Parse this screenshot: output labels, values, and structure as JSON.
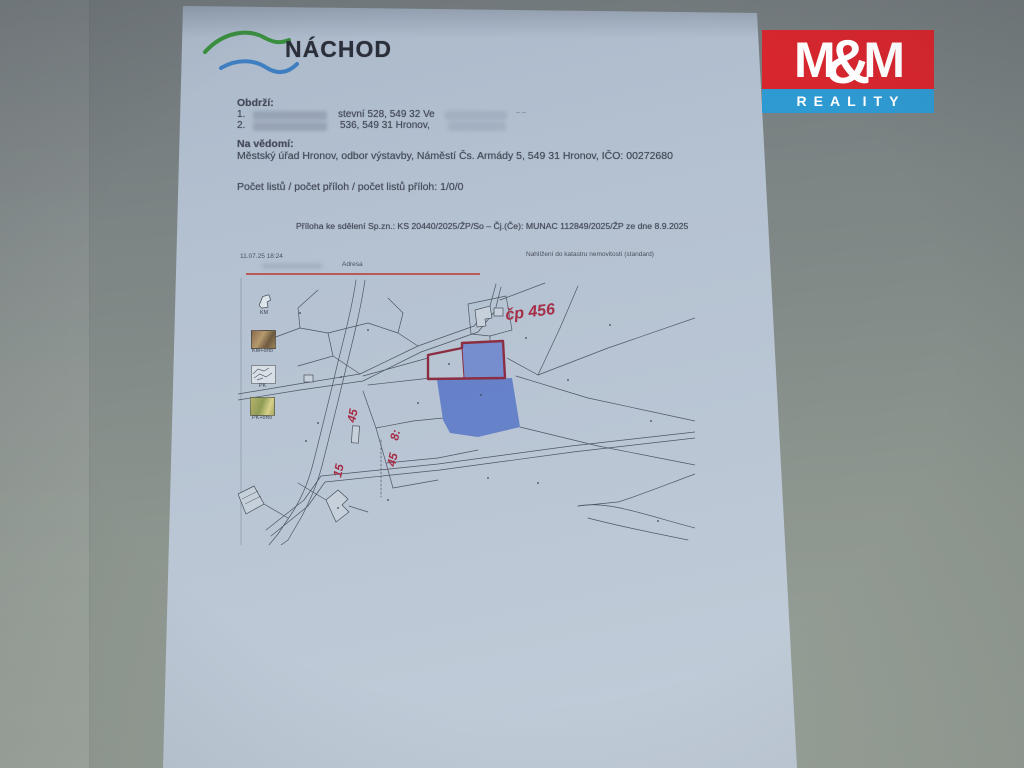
{
  "nachod": {
    "name": "NÁCHOD"
  },
  "mm_logo": {
    "m1": "M",
    "amp": "&",
    "m2": "M",
    "line2": "REALITY",
    "red": "#d7262e",
    "blue": "#2e9ad2"
  },
  "recipients": {
    "heading": "Obdrží:",
    "items": [
      {
        "num": "1.",
        "visible_fragment": "stevní 528, 549 32 Ve",
        "trailing_mark": "– –"
      },
      {
        "num": "2.",
        "visible_fragment": "536, 549 31 Hronov,"
      }
    ]
  },
  "fyi": {
    "heading": "Na vědomí:",
    "line": "Městský úřad Hronov, odbor výstavby, Náměstí Čs. Armády 5, 549 31 Hronov, IČO: 00272680"
  },
  "counts_line": "Počet listů / počet příloh / počet listů příloh: 1/0/0",
  "attachment_line": "Příloha ke sdělení Sp.zn.: KS 20440/2025/ŽP/So – Čj.(Če): MUNAC 112849/2025/ŽP ze dne  8.9.2025",
  "map": {
    "printed_timestamp": "11.07.25 18:24",
    "source_title": "Nahlížení do katastru nemovitostí (standard)",
    "tab_label": "Adresa",
    "layer_buttons": [
      {
        "label": "KM"
      },
      {
        "label": "KM+orto"
      },
      {
        "label": "PK"
      },
      {
        "label": "PK+orto"
      }
    ],
    "handwritten": {
      "house_number": "čp 456",
      "parcel_marks": [
        "45",
        "8:",
        "45",
        "15"
      ]
    },
    "highlight_outline_color": "#8c2e42",
    "parcel_fill_color": "#5d7ac6"
  }
}
